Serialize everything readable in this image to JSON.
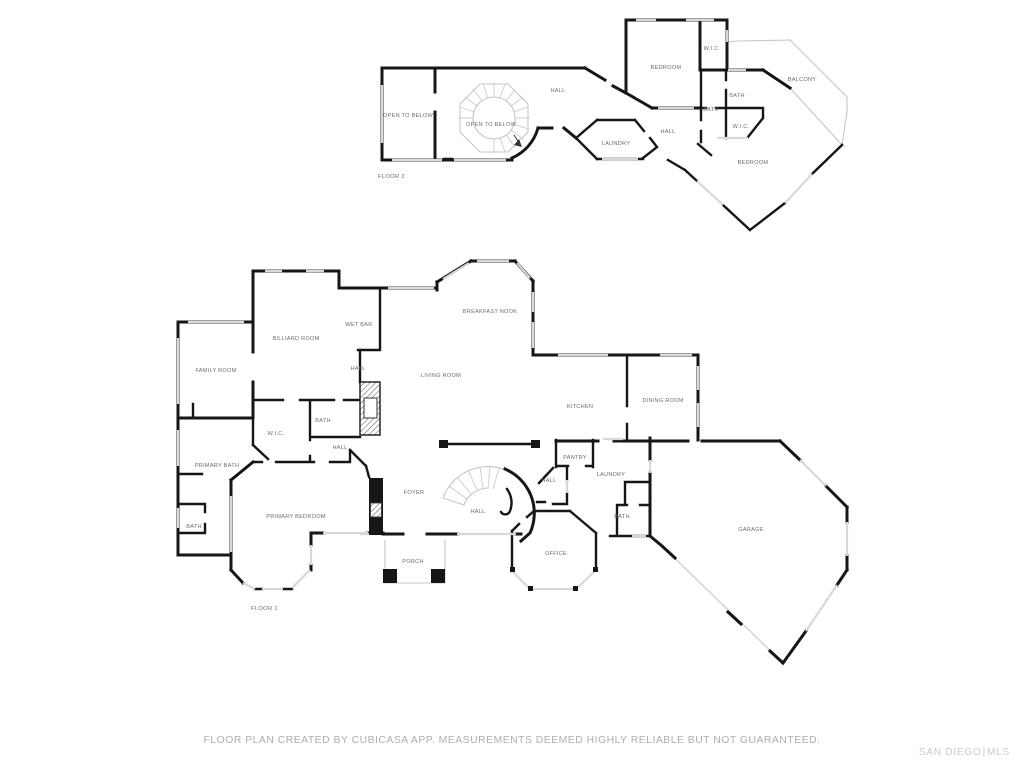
{
  "page": {
    "background": "#ffffff"
  },
  "colors": {
    "wall": "#161616",
    "window": "#d8d8d8",
    "outline": "#c6c6c6",
    "tread": "#cccccc",
    "label": "#6d6d6d",
    "disclaimer": "#aeaeae",
    "watermark": "#c9c9c9"
  },
  "footer": {
    "disclaimer": "FLOOR PLAN CREATED BY CUBICASA APP. MEASUREMENTS DEEMED HIGHLY RELIABLE BUT NOT GUARANTEED.",
    "watermark": {
      "left": "SAN DIEGO",
      "separator": "|",
      "right": "MLS"
    }
  },
  "floors": [
    {
      "name": "FLOOR 2",
      "name_pos": {
        "x": 378,
        "y": 178
      },
      "rooms": [
        {
          "label": "OPEN TO BELOW",
          "x": 408,
          "y": 117
        },
        {
          "label": "OPEN TO BELOW",
          "x": 491,
          "y": 126
        },
        {
          "label": "HALL",
          "x": 558,
          "y": 92
        },
        {
          "label": "LAUNDRY",
          "x": 616,
          "y": 145
        },
        {
          "label": "BEDROOM",
          "x": 666,
          "y": 69
        },
        {
          "label": "W.I.C.",
          "x": 712,
          "y": 50
        },
        {
          "label": "BATH",
          "x": 737,
          "y": 97
        },
        {
          "label": "BATH",
          "x": 711,
          "y": 111
        },
        {
          "label": "W.I.C.",
          "x": 741,
          "y": 128
        },
        {
          "label": "HALL",
          "x": 668,
          "y": 133
        },
        {
          "label": "BALCONY",
          "x": 802,
          "y": 81
        },
        {
          "label": "BEDROOM",
          "x": 753,
          "y": 164
        }
      ]
    },
    {
      "name": "FLOOR 1",
      "name_pos": {
        "x": 251,
        "y": 610
      },
      "rooms": [
        {
          "label": "FAMILY ROOM",
          "x": 216,
          "y": 372
        },
        {
          "label": "BILLIARD ROOM",
          "x": 296,
          "y": 340
        },
        {
          "label": "WET BAR",
          "x": 359,
          "y": 326
        },
        {
          "label": "BREAKFAST NOOK",
          "x": 490,
          "y": 313
        },
        {
          "label": "LIVING ROOM",
          "x": 441,
          "y": 377
        },
        {
          "label": "HALL",
          "x": 358,
          "y": 370
        },
        {
          "label": "KITCHEN",
          "x": 580,
          "y": 408
        },
        {
          "label": "DINING ROOM",
          "x": 663,
          "y": 402
        },
        {
          "label": "BATH",
          "x": 323,
          "y": 422
        },
        {
          "label": "W.I.C.",
          "x": 276,
          "y": 435
        },
        {
          "label": "HALL",
          "x": 340,
          "y": 449
        },
        {
          "label": "PRIMARY BATH",
          "x": 217,
          "y": 467
        },
        {
          "label": "PANTRY",
          "x": 575,
          "y": 459
        },
        {
          "label": "HALL",
          "x": 549,
          "y": 482
        },
        {
          "label": "LAUNDRY",
          "x": 611,
          "y": 476
        },
        {
          "label": "FOYER",
          "x": 414,
          "y": 494
        },
        {
          "label": "HALL",
          "x": 478,
          "y": 513
        },
        {
          "label": "BATH",
          "x": 622,
          "y": 518
        },
        {
          "label": "BATH",
          "x": 194,
          "y": 528
        },
        {
          "label": "PRIMARY BEDROOM",
          "x": 296,
          "y": 518
        },
        {
          "label": "GARAGE",
          "x": 751,
          "y": 531
        },
        {
          "label": "OFFICE",
          "x": 556,
          "y": 555
        },
        {
          "label": "PORCH",
          "x": 413,
          "y": 563
        }
      ]
    }
  ]
}
